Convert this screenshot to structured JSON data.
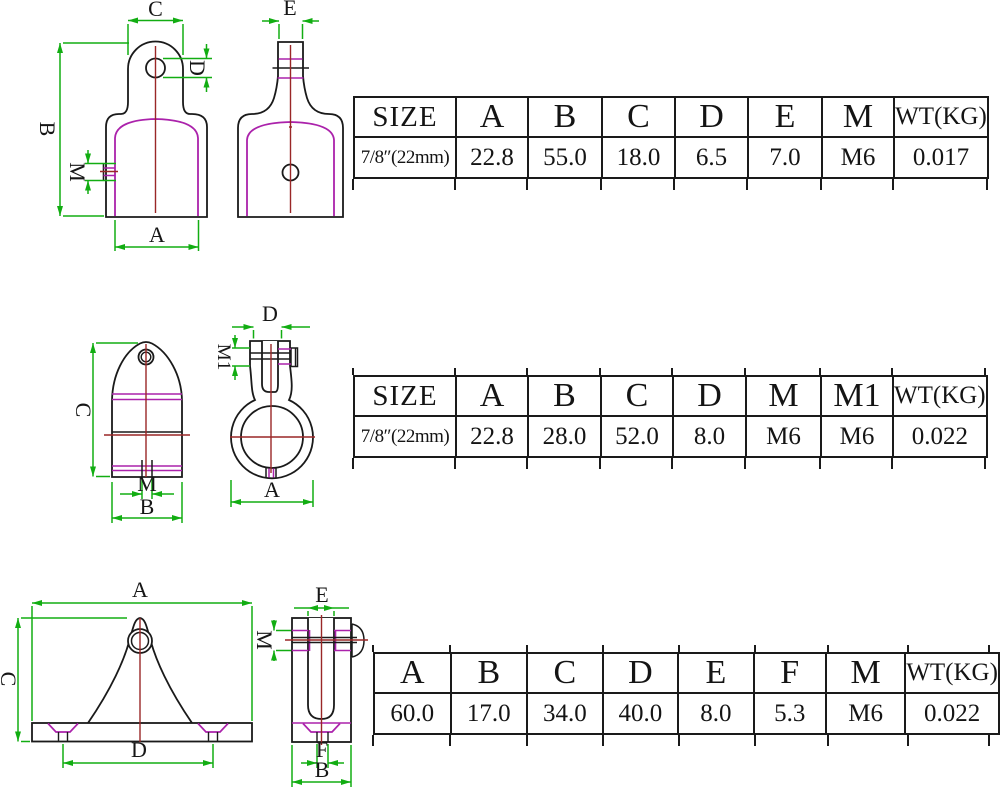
{
  "colors": {
    "background": "#ffffff",
    "outline_black": "#1a1a1a",
    "dimension_green": "#12ad12",
    "detail_magenta": "#ab22ab",
    "centerline_red": "#9a2727",
    "table_border": "#1a1a1a",
    "text": "#141414"
  },
  "sections": [
    {
      "id": "eye-end-cap",
      "drawing": {
        "dim_labels": {
          "C": "C",
          "E": "E",
          "D": "D",
          "B": "B",
          "M": "M",
          "A": "A"
        }
      },
      "table": {
        "headers": [
          "SIZE",
          "A",
          "B",
          "C",
          "D",
          "E",
          "M",
          "WT(KG)"
        ],
        "rows": [
          [
            "7/8″(22mm)",
            "22.8",
            "55.0",
            "18.0",
            "6.5",
            "7.0",
            "M6",
            "0.017"
          ]
        ]
      }
    },
    {
      "id": "jaw-slide",
      "drawing": {
        "dim_labels": {
          "D": "D",
          "M1": "M1",
          "C": "C",
          "M": "M",
          "B": "B",
          "A": "A"
        }
      },
      "table": {
        "headers": [
          "SIZE",
          "A",
          "B",
          "C",
          "D",
          "M",
          "M1",
          "WT(KG)"
        ],
        "rows": [
          [
            "7/8″(22mm)",
            "22.8",
            "28.0",
            "52.0",
            "8.0",
            "M6",
            "M6",
            "0.022"
          ]
        ]
      }
    },
    {
      "id": "deck-hinge",
      "drawing": {
        "dim_labels": {
          "A": "A",
          "E": "E",
          "M": "M",
          "C": "C",
          "D": "D",
          "F": "F",
          "B": "B"
        }
      },
      "table": {
        "headers": [
          "A",
          "B",
          "C",
          "D",
          "E",
          "F",
          "M",
          "WT(KG)"
        ],
        "rows": [
          [
            "60.0",
            "17.0",
            "34.0",
            "40.0",
            "8.0",
            "5.3",
            "M6",
            "0.022"
          ]
        ]
      }
    }
  ]
}
